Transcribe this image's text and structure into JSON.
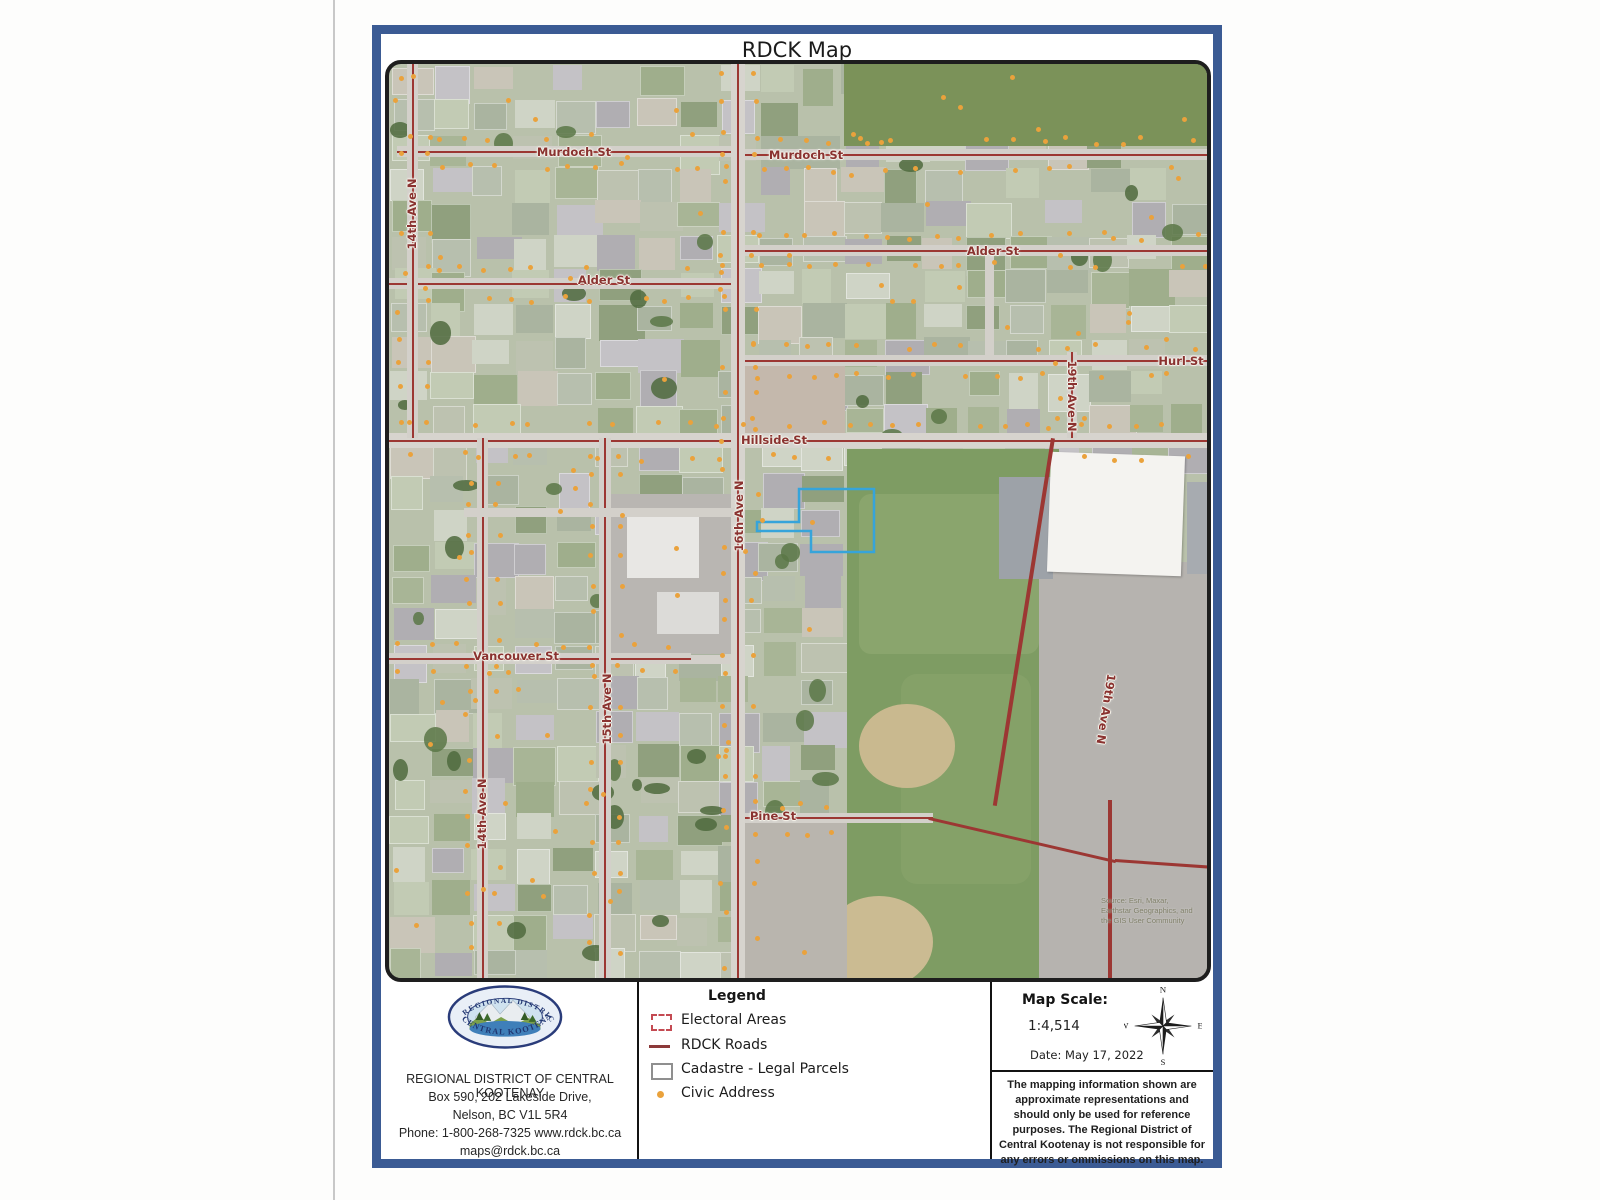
{
  "title": "RDCK Map",
  "map": {
    "street_labels": [
      {
        "text": "Murdoch St",
        "x": 185,
        "y": 88,
        "rot": 0
      },
      {
        "text": "Murdoch St",
        "x": 417,
        "y": 91,
        "rot": 0
      },
      {
        "text": "14th Ave N",
        "x": 23,
        "y": 150,
        "rot": -90
      },
      {
        "text": "Alder St",
        "x": 215,
        "y": 216,
        "rot": 0
      },
      {
        "text": "Alder St",
        "x": 604,
        "y": 187,
        "rot": 0
      },
      {
        "text": "Hurl St",
        "x": 792,
        "y": 297,
        "rot": 0
      },
      {
        "text": "19th Ave N",
        "x": 683,
        "y": 332,
        "rot": 90
      },
      {
        "text": "Hillside St",
        "x": 385,
        "y": 376,
        "rot": 0
      },
      {
        "text": "16th Ave N",
        "x": 350,
        "y": 452,
        "rot": -90
      },
      {
        "text": "Vancouver St",
        "x": 127,
        "y": 592,
        "rot": 0
      },
      {
        "text": "15th Ave N",
        "x": 218,
        "y": 645,
        "rot": -90
      },
      {
        "text": "14th Ave N",
        "x": 93,
        "y": 750,
        "rot": -90
      },
      {
        "text": "19th Ave N",
        "x": 717,
        "y": 645,
        "rot": 99
      },
      {
        "text": "Pine St",
        "x": 384,
        "y": 752,
        "rot": 0
      }
    ],
    "roads": [
      {
        "x": 8,
        "y": 82,
        "w": 340,
        "h": 11
      },
      {
        "x": 352,
        "y": 85,
        "w": 470,
        "h": 11
      },
      {
        "x": 0,
        "y": 214,
        "w": 350,
        "h": 11
      },
      {
        "x": 352,
        "y": 181,
        "w": 470,
        "h": 11
      },
      {
        "x": 352,
        "y": 291,
        "w": 470,
        "h": 11
      },
      {
        "x": 0,
        "y": 369,
        "w": 822,
        "h": 15,
        "major": true
      },
      {
        "x": 0,
        "y": 589,
        "w": 302,
        "h": 11
      },
      {
        "x": 302,
        "y": 591,
        "w": 46,
        "h": 9,
        "nored": true
      },
      {
        "x": 348,
        "y": 749,
        "w": 196,
        "h": 10
      },
      {
        "x": 540,
        "y": 753,
        "w": 192,
        "h": 3,
        "rot": 13,
        "line": true
      },
      {
        "x": 726,
        "y": 795,
        "w": 98,
        "h": 3,
        "rot": 4,
        "line": true
      },
      {
        "x": 18,
        "y": 0,
        "w": 11,
        "h": 374
      },
      {
        "x": 88,
        "y": 374,
        "w": 11,
        "h": 544
      },
      {
        "x": 210,
        "y": 374,
        "w": 12,
        "h": 544
      },
      {
        "x": 342,
        "y": 0,
        "w": 14,
        "h": 918,
        "major": true
      },
      {
        "x": 678,
        "y": 288,
        "w": 10,
        "h": 86
      },
      {
        "x": 662,
        "y": 374,
        "w": 4,
        "h": 372,
        "rot": 9,
        "line": true
      },
      {
        "x": 719,
        "y": 736,
        "w": 4,
        "h": 182,
        "line": true
      },
      {
        "x": 75,
        "y": 444,
        "w": 272,
        "h": 9,
        "nored": true
      },
      {
        "x": 596,
        "y": 181,
        "w": 9,
        "h": 110,
        "nored": true
      }
    ],
    "source_lines": [
      "Source: Esri, Maxar,",
      "Earthstar Geographics, and",
      "the GIS User Community"
    ],
    "highlight_parcel_color": "#36a4da",
    "civic_dot_color": "#eaa23c",
    "road_line_color": "#9c3733"
  },
  "footer": {
    "org_name": "REGIONAL DISTRICT OF CENTRAL KOOTENAY",
    "address_line1": "Box 590, 202 Lakeside Drive,",
    "address_line2": "Nelson, BC  V1L 5R4",
    "phone_line": "Phone: 1-800-268-7325  www.rdck.bc.ca",
    "email": "maps@rdck.bc.ca",
    "logo": {
      "top_text": "REGIONAL DISTRICT",
      "bottom_text": "CENTRAL KOOTENAY"
    },
    "legend": {
      "title": "Legend",
      "items": [
        {
          "label": "Electoral Areas"
        },
        {
          "label": "RDCK Roads"
        },
        {
          "label": "Cadastre - Legal Parcels"
        },
        {
          "label": "Civic Address"
        }
      ]
    },
    "scale": {
      "heading": "Map Scale:",
      "value": "1:4,514",
      "date": "Date: May 17, 2022"
    },
    "compass": {
      "n": "N",
      "e": "E",
      "s": "S",
      "w": "W"
    },
    "disclaimer": "The mapping information shown are approximate representations and should only be used for reference purposes. The Regional District of Central Kootenay is not responsible for any errors or ommissions on this map."
  }
}
